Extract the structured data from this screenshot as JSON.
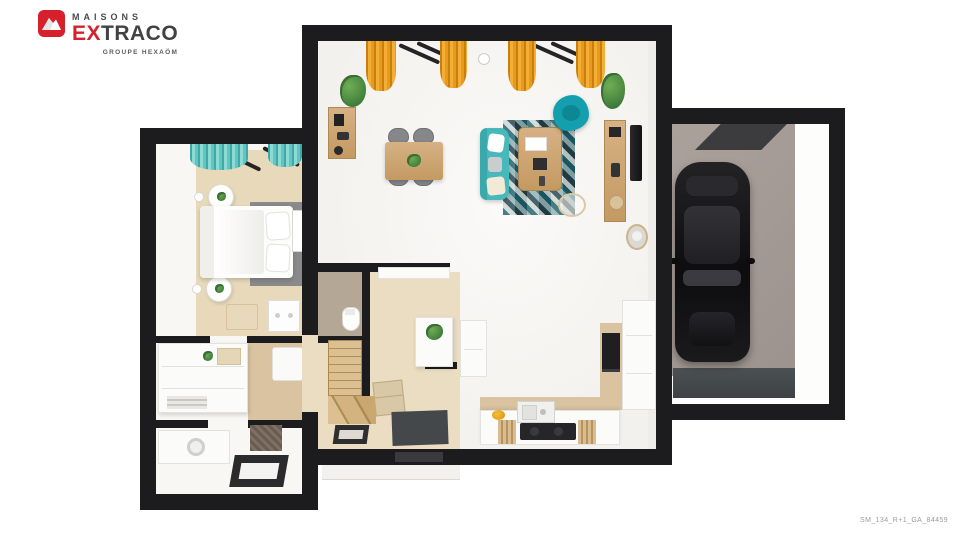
{
  "brand": {
    "maisons": "MAISONS",
    "extraco_prefix": "EX",
    "extraco_suffix": "TRACO",
    "subtitle": "GROUPE HEXAÖM",
    "logo_icon": "mountain-icon"
  },
  "footer": {
    "reference_code": "SM_134_R+1_GA_84459"
  },
  "palette": {
    "wall": "#1c1c1e",
    "floor_light": "#f7f6f3",
    "floor_beige": "#eaddc1",
    "tile_beige": "#d9c3a1",
    "carpet_beige": "#e7d9ba",
    "teal_sofa": "#48b9ba",
    "teal_armchair": "#149fae",
    "teal_curtain": "#63c5c1",
    "orange_curtain": "#e9991d",
    "wood": "#cfa873",
    "gray_rug": "#8a8a8a",
    "garage_floor": "#a79d97",
    "car_black": "#151517",
    "mat_dark": "#44484b",
    "logo_red": "#d6202c",
    "text_dark": "#424245"
  }
}
